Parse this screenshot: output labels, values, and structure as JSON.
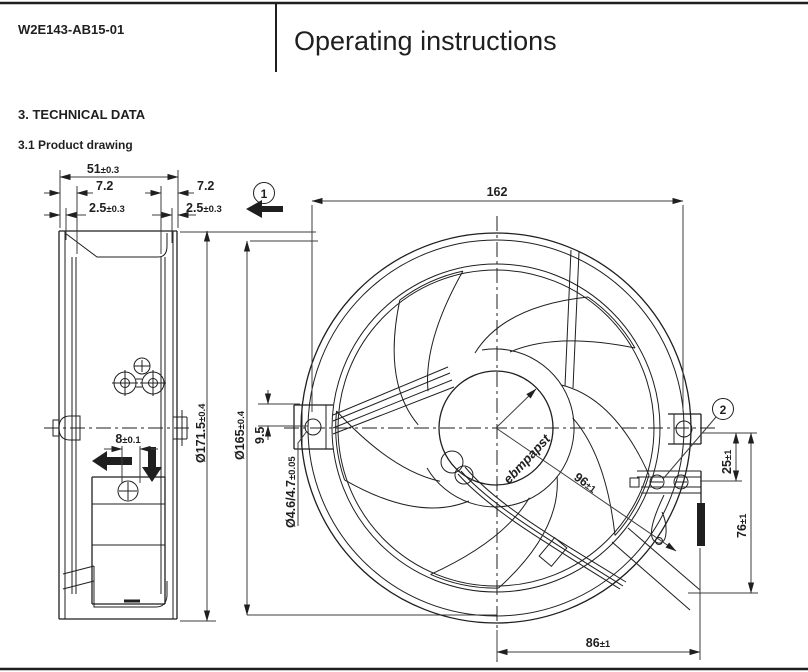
{
  "header": {
    "doc_number": "W2E143-AB15-01",
    "title": "Operating instructions"
  },
  "section": {
    "heading": "3. TECHNICAL DATA",
    "subheading": "3.1 Product drawing"
  },
  "drawing": {
    "balloons": {
      "one": "1",
      "two": "2"
    },
    "hub_logo": "ebmpapst",
    "dims": {
      "depth": {
        "value": "51",
        "tol": "±0.3"
      },
      "flange_left": {
        "value": "7.2",
        "tol": ""
      },
      "flange_right": {
        "value": "7.2",
        "tol": ""
      },
      "lip_left": {
        "value": "2.5",
        "tol": "±0.3"
      },
      "lip_right": {
        "value": "2.5",
        "tol": "±0.3"
      },
      "cable_offset": {
        "value": "8",
        "tol": "±0.1"
      },
      "outer_diameter": {
        "value": "Ø171.5",
        "tol": "±0.4"
      },
      "mount_diameter": {
        "value": "Ø165",
        "tol": "±0.4"
      },
      "width": {
        "value": "162",
        "tol": ""
      },
      "bracket_offset": {
        "value": "9.5",
        "tol": ""
      },
      "hole_diameter": {
        "value": "Ø4.6/4.7",
        "tol": "±0.05"
      },
      "hub_diameter": {
        "value": "96",
        "tol": "±1"
      },
      "terminal_top": {
        "value": "25",
        "tol": "±1"
      },
      "terminal_height": {
        "value": "76",
        "tol": "±1"
      },
      "terminal_width": {
        "value": "86",
        "tol": "±1"
      }
    }
  },
  "colors": {
    "line": "#1f1f1f",
    "dim": "#3c3c3c",
    "background": "#ffffff"
  }
}
